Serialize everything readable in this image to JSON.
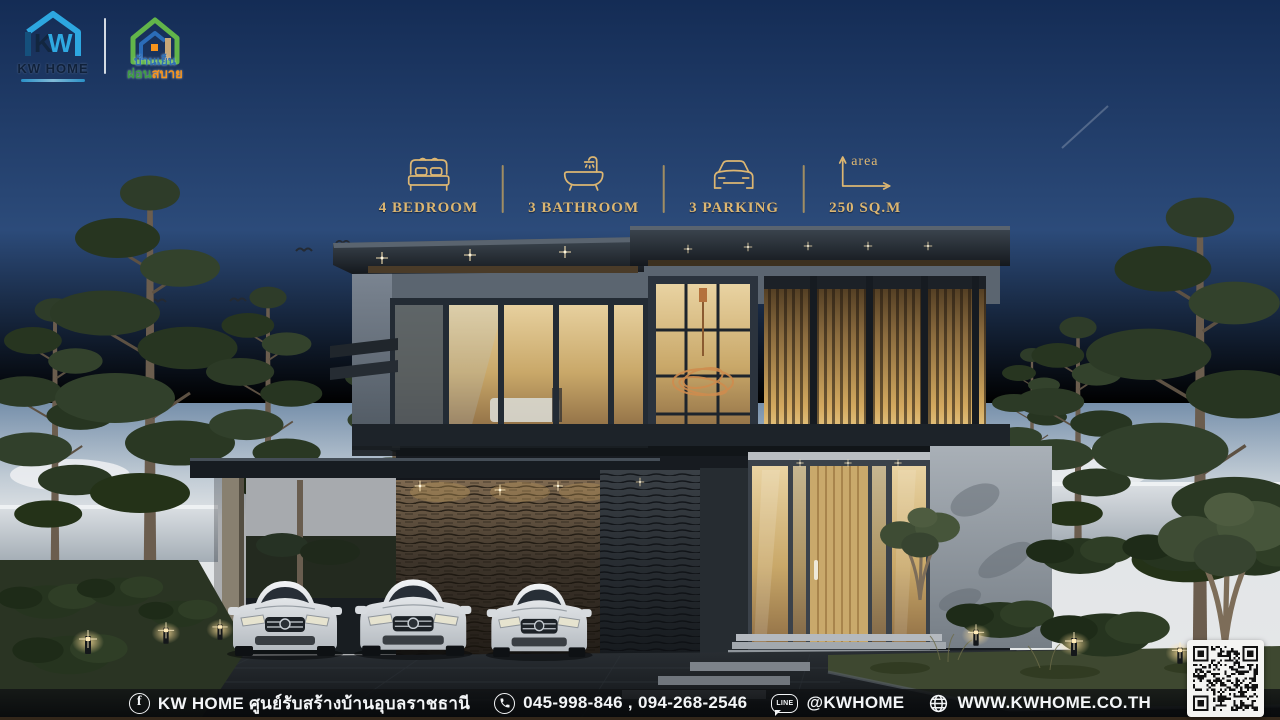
{
  "poster": {
    "title": "MODERN HOUSE 23",
    "price_range": "4,750,000 - 4,950,000 THB"
  },
  "brand": {
    "kw_name": "KW HOME",
    "partner_line1": "บ้านเย็น",
    "partner_line2a": "ผ่อน",
    "partner_line2b": "สบาย"
  },
  "features": [
    {
      "icon": "bed-icon",
      "label": "4 BEDROOM"
    },
    {
      "icon": "bathtub-icon",
      "label": "3 BATHROOM"
    },
    {
      "icon": "car-icon",
      "label": "3 PARKING"
    },
    {
      "icon": "area-icon",
      "icon_caption": "area",
      "label": "250 SQ.M"
    }
  ],
  "footer": {
    "facebook_icon_letter": "f",
    "facebook_text": "KW HOME ศูนย์รับสร้างบ้านอุบลราชธานี",
    "phone_text": "045-998-846 , 094-268-2546",
    "line_icon_text": "LINE",
    "line_text": "@KWHOME",
    "website_text": "WWW.KWHOME.CO.TH"
  },
  "colors": {
    "gold": "#dcb672",
    "sky_top": "#152e58",
    "sky_horizon": "#e2e5e7",
    "kw_blue": "#2da7e0",
    "partner_green": "#62b54a",
    "partner_orange": "#f7941d",
    "footer_bg": "#0c0e10"
  }
}
